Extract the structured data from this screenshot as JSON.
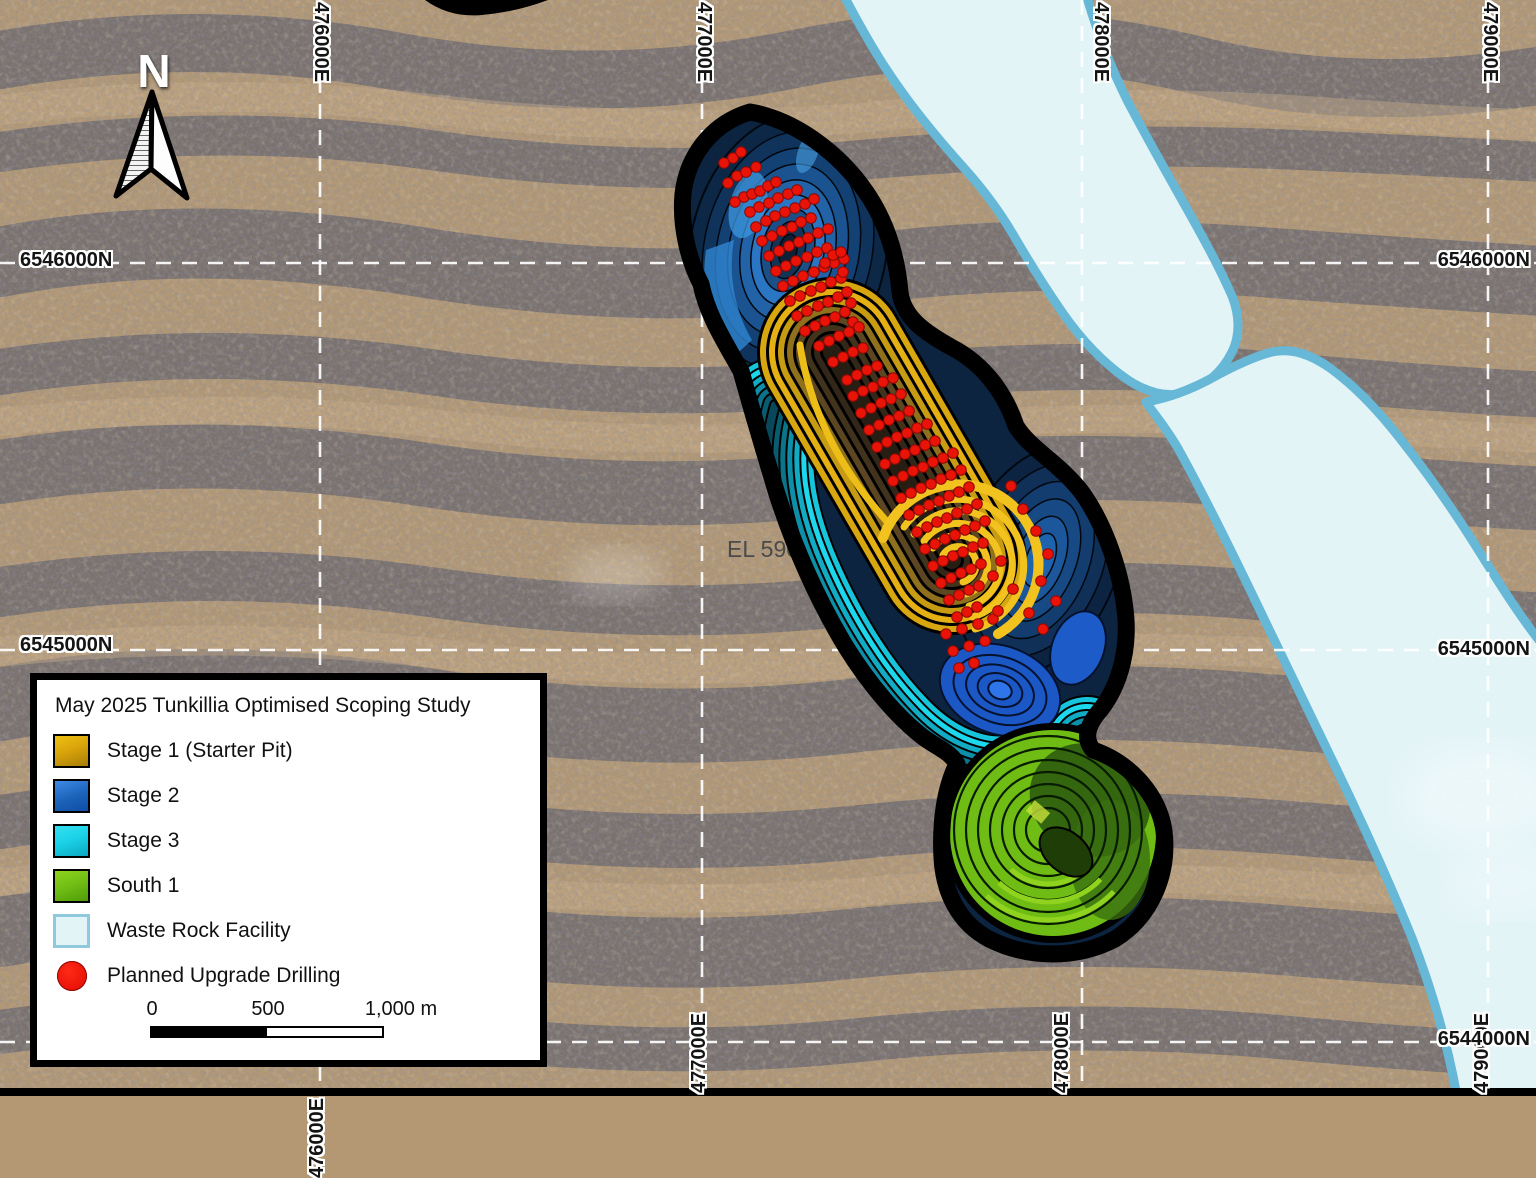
{
  "map": {
    "el_label": "EL 590",
    "north_label": "N",
    "grid": {
      "top": [
        {
          "text": "476000E",
          "x": 320
        },
        {
          "text": "477000E",
          "x": 703
        },
        {
          "text": "478000E",
          "x": 1100
        },
        {
          "text": "479000E",
          "x": 1489
        }
      ],
      "bottom": [
        {
          "text": "476000E",
          "x": 318,
          "y": 1178
        },
        {
          "text": "477000E",
          "x": 700,
          "y": 1093
        },
        {
          "text": "478000E",
          "x": 1063,
          "y": 1093
        },
        {
          "text": "479000E",
          "x": 1483,
          "y": 1093
        }
      ],
      "left": [
        {
          "text": "6546000N",
          "y": 263
        },
        {
          "text": "6545000N",
          "y": 648
        }
      ],
      "right": [
        {
          "text": "6546000N",
          "y": 263
        },
        {
          "text": "6545000N",
          "y": 652
        },
        {
          "text": "6544000N",
          "y": 1042
        }
      ],
      "vlines_x": [
        320,
        702,
        1082,
        1488
      ],
      "hlines_y": [
        263,
        650,
        1042
      ]
    },
    "colors": {
      "stage1": "#D9A50B",
      "stage1_bright": "#F2C31F",
      "stage1_core": "#2E2414",
      "stage2": "#1B62B8",
      "stage2_dark": "#0C2440",
      "stage3": "#1BD2E8",
      "stage3_dark": "#0B7F93",
      "south1": "#6FBD14",
      "south1_dark": "#2D5C0E",
      "waste_fill": "#E3F4F7",
      "waste_border": "#67B7D7",
      "drill": "#E91308",
      "grid_line": "#FFFFFF",
      "pit_outline": "#000000"
    },
    "drill_points": [
      [
        724,
        163
      ],
      [
        733,
        158
      ],
      [
        741,
        152
      ],
      [
        728,
        183
      ],
      [
        737,
        176
      ],
      [
        746,
        172
      ],
      [
        756,
        167
      ],
      [
        735,
        202
      ],
      [
        744,
        197
      ],
      [
        752,
        194
      ],
      [
        760,
        191
      ],
      [
        768,
        186
      ],
      [
        776,
        182
      ],
      [
        750,
        212
      ],
      [
        759,
        207
      ],
      [
        769,
        203
      ],
      [
        778,
        198
      ],
      [
        788,
        194
      ],
      [
        797,
        190
      ],
      [
        756,
        227
      ],
      [
        766,
        221
      ],
      [
        775,
        216
      ],
      [
        785,
        212
      ],
      [
        795,
        208
      ],
      [
        805,
        204
      ],
      [
        814,
        199
      ],
      [
        762,
        241
      ],
      [
        772,
        236
      ],
      [
        782,
        231
      ],
      [
        792,
        227
      ],
      [
        801,
        222
      ],
      [
        811,
        218
      ],
      [
        769,
        256
      ],
      [
        779,
        251
      ],
      [
        789,
        246
      ],
      [
        799,
        242
      ],
      [
        808,
        238
      ],
      [
        818,
        233
      ],
      [
        828,
        229
      ],
      [
        776,
        271
      ],
      [
        786,
        266
      ],
      [
        796,
        261
      ],
      [
        807,
        257
      ],
      [
        817,
        252
      ],
      [
        827,
        248
      ],
      [
        783,
        286
      ],
      [
        793,
        281
      ],
      [
        803,
        276
      ],
      [
        814,
        272
      ],
      [
        824,
        267
      ],
      [
        834,
        263
      ],
      [
        844,
        259
      ],
      [
        790,
        301
      ],
      [
        800,
        296
      ],
      [
        811,
        291
      ],
      [
        821,
        287
      ],
      [
        831,
        282
      ],
      [
        841,
        278
      ],
      [
        797,
        316
      ],
      [
        807,
        311
      ],
      [
        818,
        306
      ],
      [
        828,
        302
      ],
      [
        838,
        297
      ],
      [
        805,
        331
      ],
      [
        815,
        326
      ],
      [
        825,
        321
      ],
      [
        835,
        317
      ],
      [
        845,
        312
      ],
      [
        833,
        255
      ],
      [
        841,
        252
      ],
      [
        825,
        263
      ],
      [
        843,
        272
      ],
      [
        847,
        292
      ],
      [
        851,
        303
      ],
      [
        853,
        322
      ],
      [
        819,
        346
      ],
      [
        829,
        341
      ],
      [
        839,
        336
      ],
      [
        849,
        332
      ],
      [
        859,
        327
      ],
      [
        833,
        362
      ],
      [
        843,
        357
      ],
      [
        853,
        352
      ],
      [
        863,
        348
      ],
      [
        847,
        380
      ],
      [
        857,
        375
      ],
      [
        867,
        370
      ],
      [
        877,
        366
      ],
      [
        853,
        396
      ],
      [
        863,
        391
      ],
      [
        873,
        387
      ],
      [
        883,
        382
      ],
      [
        893,
        378
      ],
      [
        861,
        413
      ],
      [
        871,
        408
      ],
      [
        881,
        403
      ],
      [
        891,
        399
      ],
      [
        901,
        394
      ],
      [
        869,
        430
      ],
      [
        879,
        425
      ],
      [
        889,
        420
      ],
      [
        899,
        416
      ],
      [
        909,
        411
      ],
      [
        877,
        447
      ],
      [
        887,
        442
      ],
      [
        897,
        437
      ],
      [
        907,
        433
      ],
      [
        917,
        428
      ],
      [
        927,
        424
      ],
      [
        885,
        464
      ],
      [
        895,
        459
      ],
      [
        905,
        454
      ],
      [
        915,
        450
      ],
      [
        925,
        445
      ],
      [
        935,
        441
      ],
      [
        893,
        481
      ],
      [
        903,
        476
      ],
      [
        913,
        471
      ],
      [
        923,
        467
      ],
      [
        933,
        462
      ],
      [
        943,
        458
      ],
      [
        953,
        453
      ],
      [
        901,
        498
      ],
      [
        911,
        493
      ],
      [
        921,
        488
      ],
      [
        931,
        484
      ],
      [
        941,
        479
      ],
      [
        951,
        475
      ],
      [
        961,
        470
      ],
      [
        909,
        515
      ],
      [
        919,
        510
      ],
      [
        929,
        505
      ],
      [
        939,
        501
      ],
      [
        949,
        496
      ],
      [
        959,
        492
      ],
      [
        969,
        487
      ],
      [
        917,
        532
      ],
      [
        927,
        527
      ],
      [
        937,
        522
      ],
      [
        947,
        518
      ],
      [
        957,
        513
      ],
      [
        967,
        509
      ],
      [
        977,
        504
      ],
      [
        925,
        549
      ],
      [
        935,
        544
      ],
      [
        945,
        539
      ],
      [
        955,
        535
      ],
      [
        965,
        530
      ],
      [
        975,
        526
      ],
      [
        985,
        521
      ],
      [
        933,
        566
      ],
      [
        943,
        561
      ],
      [
        953,
        556
      ],
      [
        963,
        552
      ],
      [
        973,
        547
      ],
      [
        983,
        543
      ],
      [
        941,
        583
      ],
      [
        951,
        578
      ],
      [
        961,
        573
      ],
      [
        971,
        569
      ],
      [
        981,
        564
      ],
      [
        949,
        600
      ],
      [
        959,
        595
      ],
      [
        969,
        590
      ],
      [
        979,
        586
      ],
      [
        957,
        617
      ],
      [
        967,
        612
      ],
      [
        977,
        607
      ],
      [
        946,
        634
      ],
      [
        962,
        629
      ],
      [
        978,
        624
      ],
      [
        993,
        619
      ],
      [
        953,
        651
      ],
      [
        969,
        646
      ],
      [
        985,
        641
      ],
      [
        959,
        668
      ],
      [
        974,
        663
      ],
      [
        1011,
        486
      ],
      [
        1023,
        509
      ],
      [
        1036,
        531
      ],
      [
        1048,
        554
      ],
      [
        1041,
        581
      ],
      [
        1056,
        601
      ],
      [
        1001,
        561
      ],
      [
        993,
        576
      ],
      [
        1013,
        589
      ],
      [
        1029,
        613
      ],
      [
        1043,
        629
      ],
      [
        998,
        611
      ]
    ]
  },
  "legend": {
    "title": "May 2025 Tunkillia Optimised Scoping Study",
    "items": [
      {
        "label": "Stage 1 (Starter Pit)"
      },
      {
        "label": "Stage 2"
      },
      {
        "label": "Stage 3"
      },
      {
        "label": "South 1"
      },
      {
        "label": "Waste Rock Facility"
      },
      {
        "label": "Planned Upgrade Drilling"
      }
    ],
    "scale_bar": {
      "tick0": "0",
      "tick500": "500",
      "tick1000": "1,000 m"
    }
  }
}
